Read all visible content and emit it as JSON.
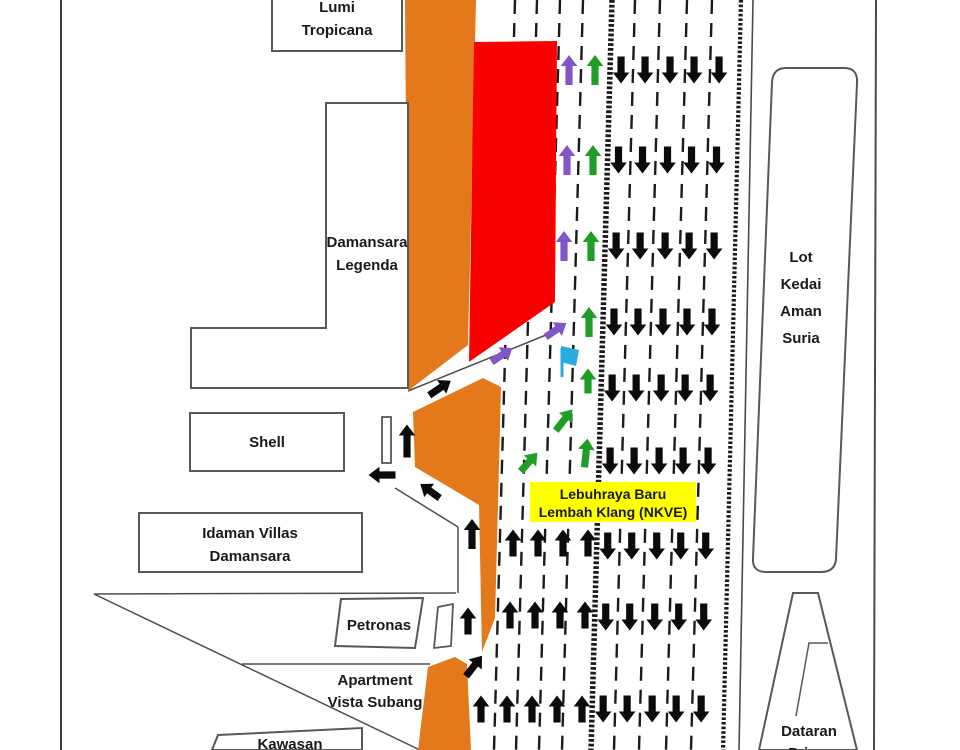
{
  "map": {
    "buildings": {
      "lumi_tropicana": [
        "Lumi",
        "Tropicana"
      ],
      "damansara_legenda": [
        "Damansara",
        "Legenda"
      ],
      "shell": [
        "Shell"
      ],
      "idaman_villas": [
        "Idaman Villas",
        "Damansara"
      ],
      "petronas": [
        "Petronas"
      ],
      "apartment_vista_subang": [
        "Apartment",
        "Vista Subang"
      ],
      "kawasan": [
        "Kawasan"
      ],
      "lot_kedai_aman_suria": [
        "Lot",
        "Kedai",
        "Aman",
        "Suria"
      ],
      "dataran_prima": [
        "Dataran",
        "Prima"
      ]
    },
    "highway_label": [
      "Lebuhraya Baru",
      "Lembah Klang (NKVE)"
    ],
    "colors": {
      "closed_road_orange": "#E4791B",
      "closed_area_red": "#FB0000",
      "route_purple": "#8257C5",
      "route_green": "#1F9D27",
      "flag_blue": "#29ABE2",
      "label_yellow": "#FFFF00",
      "traffic_black": "#0B0B0B",
      "outline_gray": "#585858",
      "line_dark": "#3D3D3D"
    },
    "icons": {
      "flag": "checkpoint-flag-icon",
      "up_arrow": "lane-direction-up-arrow",
      "down_arrow": "lane-direction-down-arrow",
      "merge_arrow": "diverted-route-merge-arrow"
    }
  }
}
